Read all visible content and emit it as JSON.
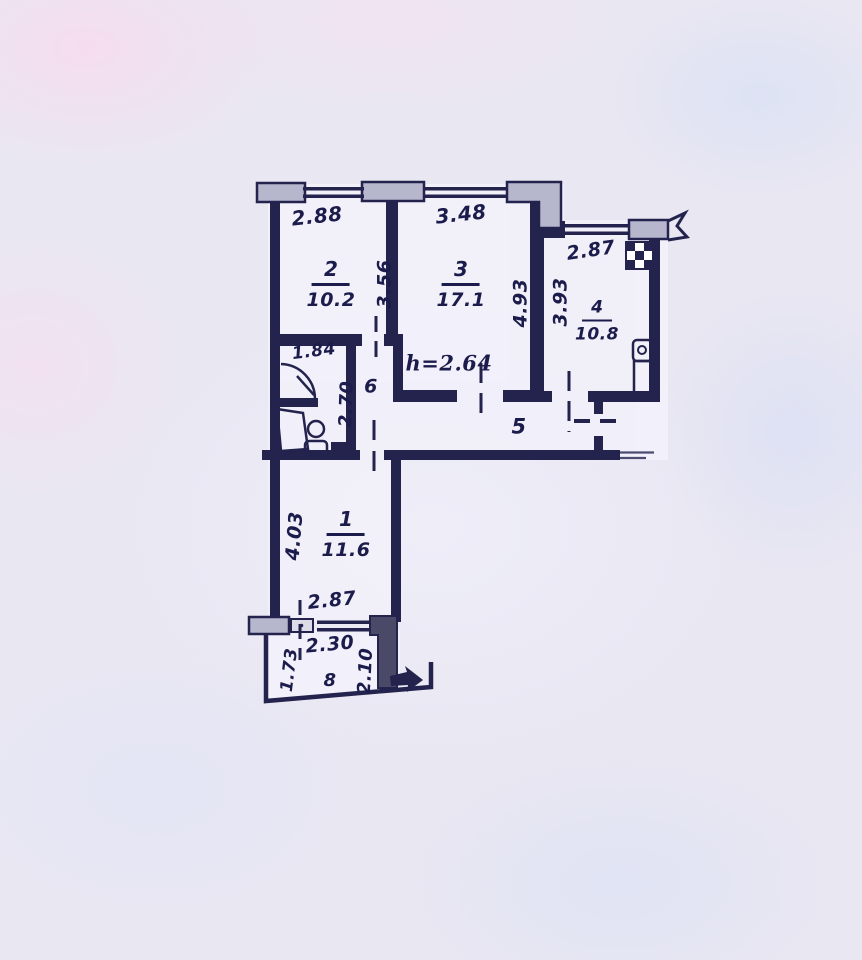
{
  "floor_plan": {
    "ceiling_height_label": "h=2.64",
    "rooms": [
      {
        "number": "2",
        "area": "10.2"
      },
      {
        "number": "3",
        "area": "17.1"
      },
      {
        "number": "4",
        "area": "10.8"
      },
      {
        "number": "1",
        "area": "11.6"
      },
      {
        "number": "5"
      },
      {
        "number": "6"
      },
      {
        "number": "8"
      }
    ],
    "dimensions": {
      "room2_width": "2.88",
      "room2_depth": "3.56",
      "room3_width": "3.48",
      "room3_depth": "4.93",
      "room4_width": "2.87",
      "room4_depth": "3.93",
      "wc_width": "1.84",
      "wc_depth": "2.70",
      "room1_depth": "4.03",
      "room1_width": "2.87",
      "balcony_width": "2.30",
      "balcony_left_depth": "1.73",
      "balcony_right_depth": "2.10"
    },
    "colors": {
      "ink": "#23234e",
      "paper": "#e9e7f2",
      "sill_fill": "#b6b6cd"
    }
  }
}
